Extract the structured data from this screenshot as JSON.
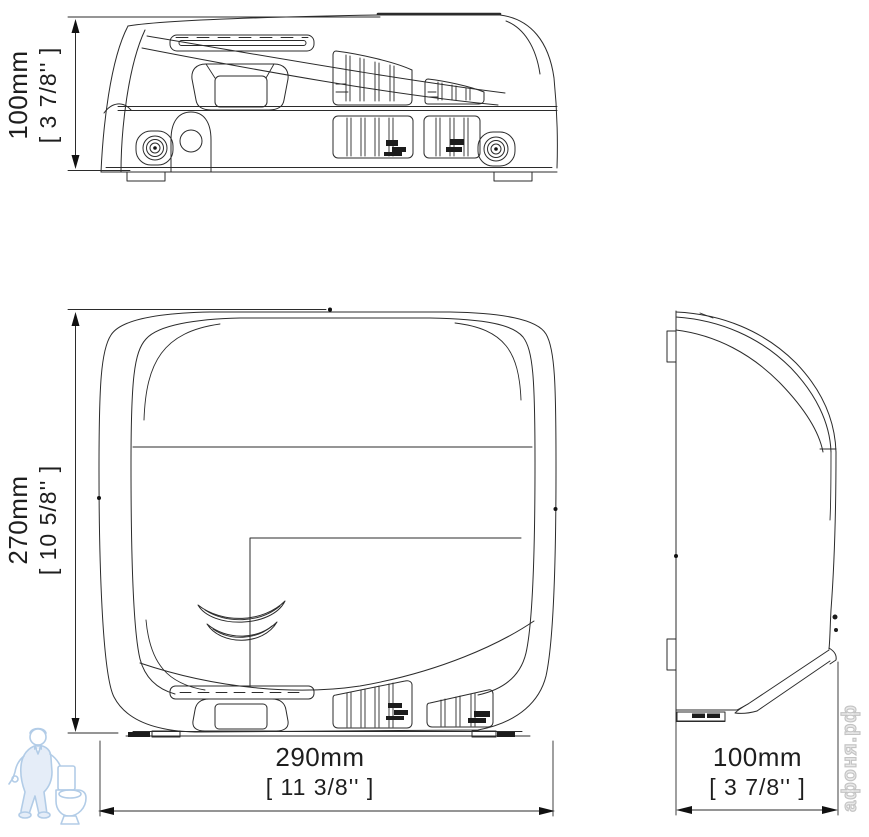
{
  "drawing": {
    "type": "hand-dryer technical dimension drawing, three orthographic views",
    "accent_line_color": "#2b2b2b",
    "watermark_color": "#c3c3c3",
    "mascot_color": "#aecae6"
  },
  "dimensions": {
    "top_view_height": {
      "metric": "100mm",
      "imperial": "[ 3 7/8'' ]"
    },
    "front_view_height": {
      "metric": "270mm",
      "imperial": "[ 10 5/8'' ]"
    },
    "front_view_width": {
      "metric": "290mm",
      "imperial": "[ 11 3/8'' ]"
    },
    "side_view_depth": {
      "metric": "100mm",
      "imperial": "[ 3 7/8'' ]"
    }
  },
  "watermark": {
    "site_text": "афоня.рф"
  }
}
